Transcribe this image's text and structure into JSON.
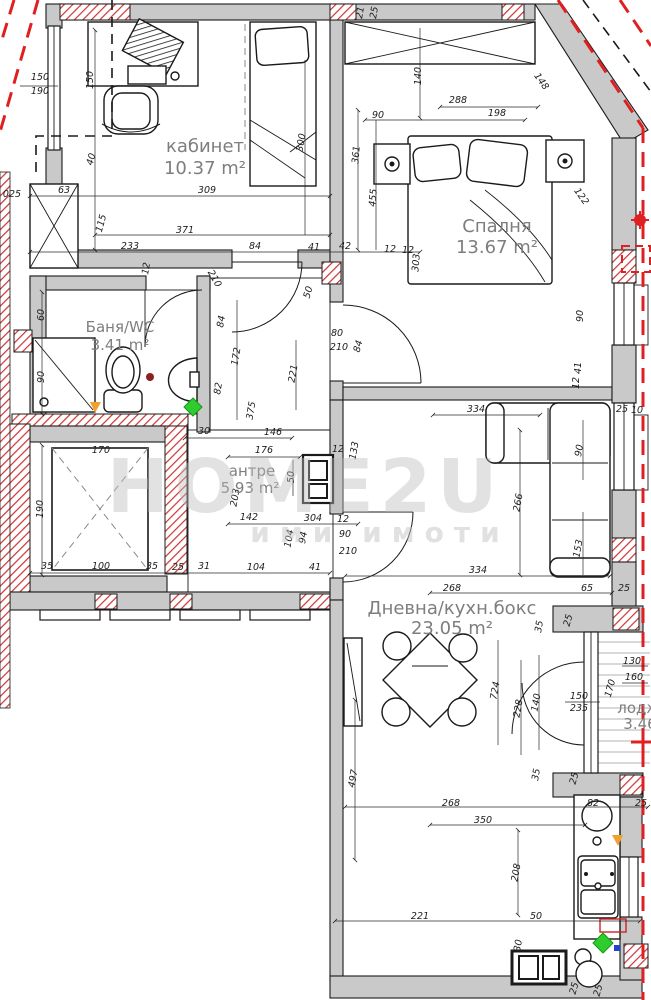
{
  "watermark": {
    "line1": "HOME2U",
    "line2": "ими имоти"
  },
  "rooms": [
    {
      "name": "кабинет",
      "area": "10.37 m²"
    },
    {
      "name": "Спалня",
      "area": "13.67 m²"
    },
    {
      "name": "Баня/WC",
      "area": "3.41 m²"
    },
    {
      "name": "антре",
      "area": "5.93 m²"
    },
    {
      "name": "Дневна/кухн.бокс",
      "area": "23.05 m²"
    },
    {
      "name": "лоджия",
      "area": "3.46"
    }
  ],
  "colors": {
    "wall_gray": "#c9c9c9",
    "line": "#1a1a1a",
    "hatch_red": "#cc3333",
    "bath_hatch": "#a65555",
    "floor_stripe": "#b4b4b4",
    "boundary_red": "#e02020",
    "label_gray": "#7e7e7e",
    "watermark_gray": "#bcbcbc",
    "marker_green": "#2ecc2e",
    "marker_orange": "#f0a030",
    "marker_blue": "#2244cc"
  },
  "dimensions": [
    {
      "t": "150",
      "x": 40,
      "y": 80,
      "r": 0
    },
    {
      "t": "190",
      "x": 40,
      "y": 94,
      "r": 0
    },
    {
      "t": "150",
      "x": 93,
      "y": 80,
      "r": -90
    },
    {
      "t": "40",
      "x": 94,
      "y": 160,
      "r": -75
    },
    {
      "t": "115",
      "x": 104,
      "y": 224,
      "r": -75
    },
    {
      "t": "300",
      "x": 304,
      "y": 143,
      "r": -80
    },
    {
      "t": "025",
      "x": 12,
      "y": 197,
      "r": 0
    },
    {
      "t": "63",
      "x": 64,
      "y": 193,
      "r": 0
    },
    {
      "t": "309",
      "x": 207,
      "y": 193,
      "r": 0
    },
    {
      "t": "371",
      "x": 185,
      "y": 233,
      "r": 0
    },
    {
      "t": "233",
      "x": 130,
      "y": 249,
      "r": 0
    },
    {
      "t": "84",
      "x": 255,
      "y": 249,
      "r": 0
    },
    {
      "t": "41",
      "x": 314,
      "y": 250,
      "r": 0
    },
    {
      "t": "12",
      "x": 390,
      "y": 252,
      "r": 0
    },
    {
      "t": "12",
      "x": 408,
      "y": 253,
      "r": 0
    },
    {
      "t": "42",
      "x": 345,
      "y": 249,
      "r": 0
    },
    {
      "t": "21",
      "x": 363,
      "y": 13,
      "r": -80
    },
    {
      "t": "25",
      "x": 377,
      "y": 13,
      "r": -80
    },
    {
      "t": "140",
      "x": 421,
      "y": 76,
      "r": -90
    },
    {
      "t": "288",
      "x": 458,
      "y": 103,
      "r": 0
    },
    {
      "t": "90",
      "x": 378,
      "y": 118,
      "r": 0
    },
    {
      "t": "198",
      "x": 497,
      "y": 116,
      "r": 0
    },
    {
      "t": "361",
      "x": 359,
      "y": 155,
      "r": -85
    },
    {
      "t": "455",
      "x": 376,
      "y": 198,
      "r": -85
    },
    {
      "t": "148",
      "x": 539,
      "y": 83,
      "r": 55
    },
    {
      "t": "122",
      "x": 579,
      "y": 198,
      "r": 55
    },
    {
      "t": "303",
      "x": 419,
      "y": 263,
      "r": -85
    },
    {
      "t": "90",
      "x": 583,
      "y": 316,
      "r": -90
    },
    {
      "t": "41",
      "x": 581,
      "y": 368,
      "r": -90
    },
    {
      "t": "12",
      "x": 579,
      "y": 383,
      "r": -90
    },
    {
      "t": "210",
      "x": 212,
      "y": 280,
      "r": 60
    },
    {
      "t": "84",
      "x": 224,
      "y": 322,
      "r": -80
    },
    {
      "t": "50",
      "x": 311,
      "y": 293,
      "r": -75
    },
    {
      "t": "60",
      "x": 44,
      "y": 315,
      "r": -90
    },
    {
      "t": "90",
      "x": 44,
      "y": 377,
      "r": -90
    },
    {
      "t": "82",
      "x": 221,
      "y": 389,
      "r": -80
    },
    {
      "t": "172",
      "x": 239,
      "y": 357,
      "r": -80
    },
    {
      "t": "221",
      "x": 296,
      "y": 374,
      "r": -80
    },
    {
      "t": "375",
      "x": 254,
      "y": 411,
      "r": -80
    },
    {
      "t": "12",
      "x": 149,
      "y": 269,
      "r": -80
    },
    {
      "t": "30",
      "x": 204,
      "y": 434,
      "r": 0
    },
    {
      "t": "146",
      "x": 273,
      "y": 435,
      "r": 0
    },
    {
      "t": "176",
      "x": 264,
      "y": 453,
      "r": 0
    },
    {
      "t": "133",
      "x": 357,
      "y": 451,
      "r": -80
    },
    {
      "t": "12",
      "x": 338,
      "y": 452,
      "r": 0
    },
    {
      "t": "50",
      "x": 294,
      "y": 477,
      "r": -90
    },
    {
      "t": "203",
      "x": 238,
      "y": 498,
      "r": -80
    },
    {
      "t": "142",
      "x": 249,
      "y": 520,
      "r": 0
    },
    {
      "t": "304",
      "x": 313,
      "y": 521,
      "r": 0
    },
    {
      "t": "12",
      "x": 343,
      "y": 522,
      "r": 0
    },
    {
      "t": "90",
      "x": 345,
      "y": 537,
      "r": 0
    },
    {
      "t": "210",
      "x": 348,
      "y": 554,
      "r": 0
    },
    {
      "t": "104",
      "x": 292,
      "y": 539,
      "r": -80
    },
    {
      "t": "94",
      "x": 306,
      "y": 538,
      "r": -80
    },
    {
      "t": "170",
      "x": 101,
      "y": 453,
      "r": 0
    },
    {
      "t": "190",
      "x": 43,
      "y": 509,
      "r": -90
    },
    {
      "t": "35",
      "x": 47,
      "y": 569,
      "r": 0
    },
    {
      "t": "100",
      "x": 101,
      "y": 569,
      "r": 0
    },
    {
      "t": "35",
      "x": 152,
      "y": 569,
      "r": 0
    },
    {
      "t": "25",
      "x": 178,
      "y": 570,
      "r": 0
    },
    {
      "t": "31",
      "x": 204,
      "y": 569,
      "r": 0
    },
    {
      "t": "104",
      "x": 256,
      "y": 570,
      "r": 0
    },
    {
      "t": "41",
      "x": 315,
      "y": 570,
      "r": 0
    },
    {
      "t": "80",
      "x": 337,
      "y": 336,
      "r": 0
    },
    {
      "t": "210",
      "x": 339,
      "y": 350,
      "r": 0
    },
    {
      "t": "84",
      "x": 361,
      "y": 347,
      "r": -75
    },
    {
      "t": "334",
      "x": 476,
      "y": 412,
      "r": 0
    },
    {
      "t": "25",
      "x": 622,
      "y": 412,
      "r": 0
    },
    {
      "t": "10",
      "x": 637,
      "y": 413,
      "r": 0
    },
    {
      "t": "266",
      "x": 521,
      "y": 503,
      "r": -80
    },
    {
      "t": "90",
      "x": 582,
      "y": 451,
      "r": -80
    },
    {
      "t": "153",
      "x": 581,
      "y": 549,
      "r": -80
    },
    {
      "t": "334",
      "x": 478,
      "y": 573,
      "r": 0
    },
    {
      "t": "268",
      "x": 452,
      "y": 591,
      "r": 0
    },
    {
      "t": "65",
      "x": 587,
      "y": 591,
      "r": 0
    },
    {
      "t": "25",
      "x": 624,
      "y": 591,
      "r": 0
    },
    {
      "t": "25",
      "x": 571,
      "y": 621,
      "r": -75
    },
    {
      "t": "35",
      "x": 542,
      "y": 627,
      "r": -80
    },
    {
      "t": "724",
      "x": 498,
      "y": 691,
      "r": -80
    },
    {
      "t": "228",
      "x": 521,
      "y": 709,
      "r": -80
    },
    {
      "t": "140",
      "x": 539,
      "y": 703,
      "r": -80
    },
    {
      "t": "150",
      "x": 579,
      "y": 699,
      "r": 0
    },
    {
      "t": "235",
      "x": 579,
      "y": 711,
      "r": 0
    },
    {
      "t": "170",
      "x": 613,
      "y": 689,
      "r": -75
    },
    {
      "t": "160",
      "x": 634,
      "y": 680,
      "r": 0
    },
    {
      "t": "130",
      "x": 632,
      "y": 664,
      "r": 0
    },
    {
      "t": "35",
      "x": 539,
      "y": 775,
      "r": -80
    },
    {
      "t": "25",
      "x": 577,
      "y": 779,
      "r": -75
    },
    {
      "t": "497",
      "x": 356,
      "y": 779,
      "r": -80
    },
    {
      "t": "268",
      "x": 451,
      "y": 806,
      "r": 0
    },
    {
      "t": "82",
      "x": 593,
      "y": 806,
      "r": 0
    },
    {
      "t": "25",
      "x": 641,
      "y": 806,
      "r": 0
    },
    {
      "t": "350",
      "x": 483,
      "y": 823,
      "r": 0
    },
    {
      "t": "208",
      "x": 519,
      "y": 873,
      "r": -80
    },
    {
      "t": "221",
      "x": 420,
      "y": 919,
      "r": 0
    },
    {
      "t": "50",
      "x": 536,
      "y": 919,
      "r": 0
    },
    {
      "t": "30",
      "x": 521,
      "y": 946,
      "r": -80
    },
    {
      "t": "25",
      "x": 577,
      "y": 989,
      "r": -75
    },
    {
      "t": "25",
      "x": 601,
      "y": 991,
      "r": -75
    }
  ]
}
